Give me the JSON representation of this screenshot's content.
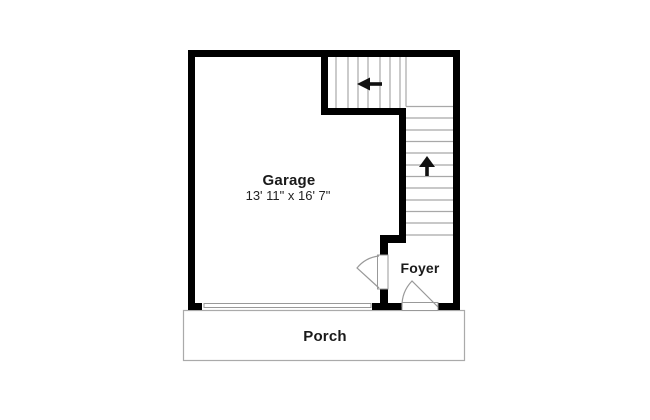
{
  "labels": {
    "garage": "Garage",
    "garage_dimensions": "13' 11\" x 16' 7\"",
    "foyer": "Foyer",
    "porch": "Porch"
  },
  "stairs": {
    "upper_run_direction": "left",
    "lower_run_direction": "up"
  },
  "icons": {
    "upper_stair_arrow": "arrow-left-icon",
    "lower_stair_arrow": "arrow-up-icon"
  },
  "colors": {
    "wall": "#000000",
    "stair_tread": "#a8a8a8",
    "door_swing": "#999999",
    "porch_outline": "#aaaaaa",
    "arrow": "#111111",
    "text": "#1a1a1a",
    "background": "#ffffff"
  }
}
